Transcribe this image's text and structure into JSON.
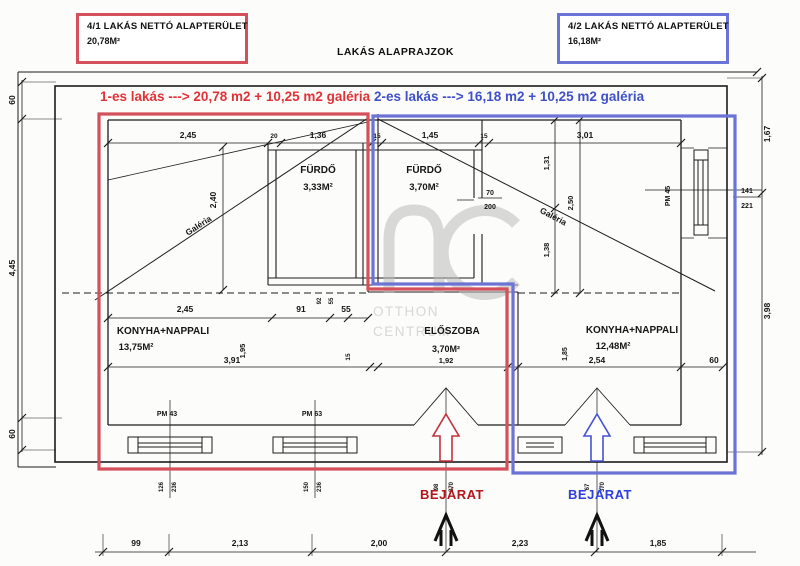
{
  "colors": {
    "apartment1_red": "#d4515c",
    "apartment2_blue": "#6b74d6",
    "note_red": "#e03238",
    "note_blue": "#4050c8",
    "entrance_red": "#b3151c",
    "entrance_blue": "#2f3ee0",
    "line_black": "#1c1c1c",
    "watermark_gray": "#bbbbbb"
  },
  "header": {
    "unit1": {
      "title": "4/1 LAKÁS NETTÓ ALAPTERÜLET",
      "area": "20,78M²"
    },
    "unit2": {
      "title": "4/2 LAKÁS NETTÓ ALAPTERÜLET",
      "area": "16,18M²"
    },
    "drawing_title": "LAKÁS ALAPRAJZOK",
    "note_red": "1-es lakás ---> 20,78 m2 + 10,25 m2 galéria",
    "note_blue": "2-es lakás ---> 16,18 m2 + 10,25 m2 galéria"
  },
  "rooms": {
    "bath1": {
      "name": "FÜRDŐ",
      "area": "3,33M²"
    },
    "bath2": {
      "name": "FÜRDŐ",
      "area": "3,70M²"
    },
    "living1": {
      "name": "KONYHA+NAPPALI",
      "area": "13,75M²"
    },
    "hall": {
      "name": "ELŐSZOBA",
      "area": "3,70M²",
      "width": "1,92"
    },
    "living2": {
      "name": "KONYHA+NAPPALI",
      "area": "12,48M²"
    }
  },
  "labels": {
    "galeria": "Galéria",
    "entrance": "BEJÁRAT",
    "pm43": "PM 43",
    "pm63": "PM 63",
    "pm45": "PM 45"
  },
  "dims": {
    "top": [
      "2,45",
      "20",
      "1,36",
      "15",
      "1,45",
      "15",
      "3,01"
    ],
    "left": [
      "60",
      "4,45",
      "60"
    ],
    "right": [
      "1,67",
      "3,98"
    ],
    "bottom": [
      "99",
      "2,13",
      "2,00",
      "2,23",
      "1,85"
    ],
    "mid": [
      "2,45",
      "91",
      "55"
    ],
    "mid_small": [
      "92",
      "55"
    ],
    "vertical": {
      "v240": "2,40",
      "v195": "1,95",
      "v131": "1,31",
      "v250": "2,50",
      "v138": "1,38",
      "v185": "1,85"
    },
    "under": {
      "d391": "3,91",
      "d254": "2,54",
      "d60": "60"
    },
    "wall15": "15",
    "door": {
      "num": "70",
      "den": "200"
    },
    "window_right": {
      "num": "141",
      "den": "221"
    },
    "tiny_pairs": [
      [
        "126",
        "236"
      ],
      [
        "150",
        "236"
      ],
      [
        "98",
        "370"
      ],
      [
        "67",
        "370"
      ]
    ]
  },
  "watermark": {
    "line1": "OTTHON",
    "line2": "CENTRUM"
  }
}
